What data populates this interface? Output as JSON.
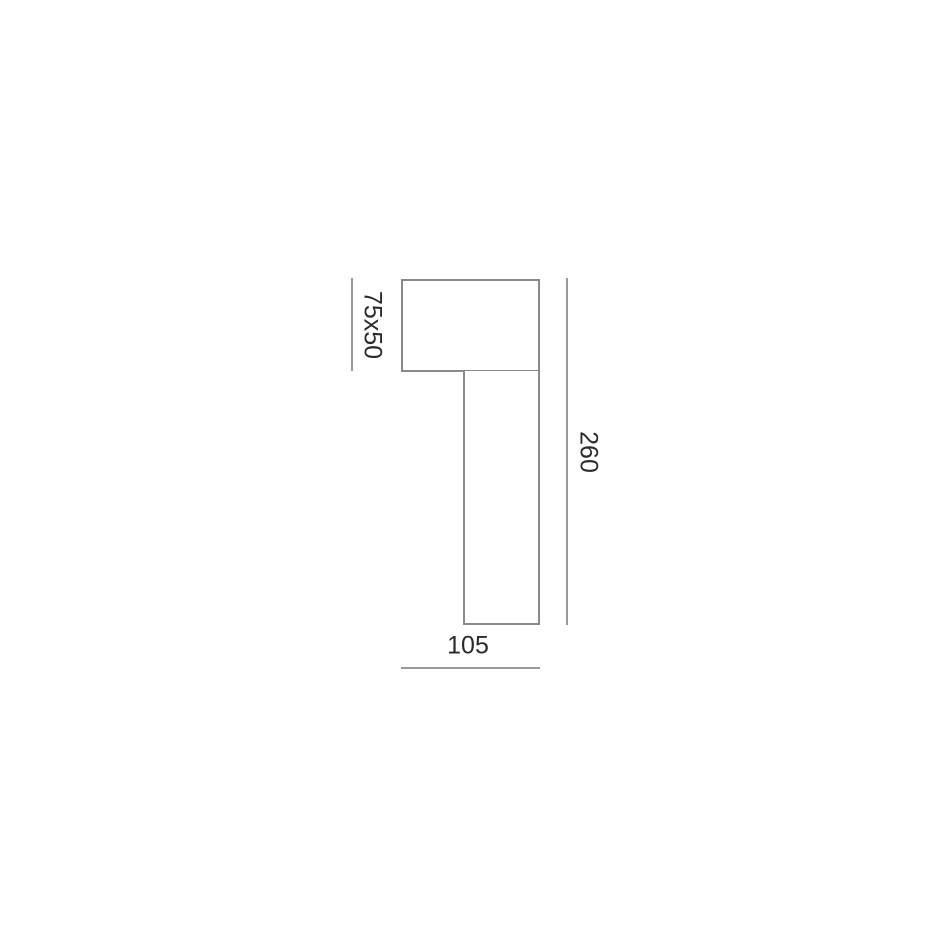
{
  "diagram": {
    "type": "technical-dimension-drawing",
    "dimensions": {
      "head": {
        "label": "75x50"
      },
      "height": {
        "label": "260"
      },
      "width": {
        "label": "105"
      }
    }
  },
  "colors": {
    "outline": "#8a8a8a",
    "dimline": "#9a9a9a",
    "text": "#2b2b2b",
    "background": "#ffffff"
  }
}
